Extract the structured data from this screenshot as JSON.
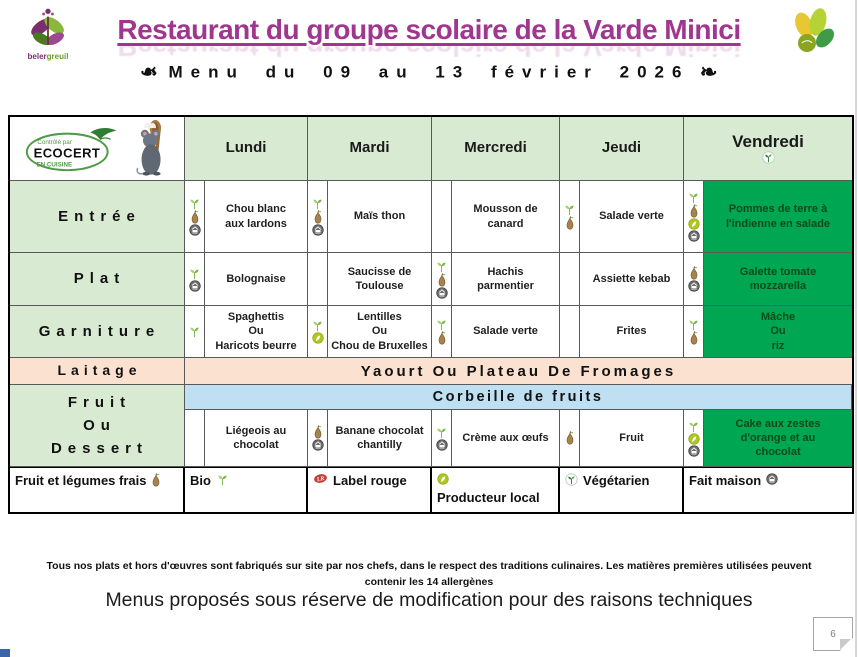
{
  "header": {
    "brand_part1": "beler",
    "brand_part2": "greuil",
    "title": "Restaurant du groupe scolaire de la Varde Minici",
    "subtitle": "Menu du 09 au 13 février 2026",
    "ornament": "❧"
  },
  "ecocert_logo": {
    "top": "Contrôlé par",
    "name": "ECOCERT",
    "bottom": "EN CUISINE"
  },
  "colors": {
    "title_purple": "#A0368F",
    "header_green": "#D9EAD3",
    "highlight_green": "#00A651",
    "laitage_peach": "#FBE2D0",
    "fruit_blue": "#BFE0F2"
  },
  "table": {
    "days": [
      {
        "label": "Lundi"
      },
      {
        "label": "Mardi"
      },
      {
        "label": "Mercredi"
      },
      {
        "label": "Jeudi"
      },
      {
        "label": "Vendredi",
        "icon": "vegetarian"
      }
    ],
    "rows": [
      {
        "label": "Entrée",
        "type": "dishes",
        "cells": [
          {
            "icons": [
              "bio",
              "fresh-produce",
              "homemade"
            ],
            "text": "Chou blanc\naux lardons"
          },
          {
            "icons": [
              "bio",
              "fresh-produce",
              "homemade"
            ],
            "text": "Maïs thon"
          },
          {
            "icons": [],
            "text": "Mousson de\ncanard"
          },
          {
            "icons": [
              "bio",
              "fresh-produce"
            ],
            "text": "Salade verte"
          },
          {
            "icons": [
              "bio",
              "fresh-produce",
              "local-producer",
              "homemade"
            ],
            "text": "Pommes de terre à\nl'indienne en salade",
            "highlight": true
          }
        ]
      },
      {
        "label": "Plat",
        "type": "dishes",
        "cells": [
          {
            "icons": [
              "bio",
              "homemade"
            ],
            "text": "Bolognaise"
          },
          {
            "icons": [],
            "text": "Saucisse de\nToulouse"
          },
          {
            "icons": [
              "bio",
              "fresh-produce",
              "homemade"
            ],
            "text": "Hachis\nparmentier"
          },
          {
            "icons": [],
            "text": "Assiette kebab"
          },
          {
            "icons": [
              "fresh-produce",
              "homemade"
            ],
            "text": "Galette tomate\nmozzarella",
            "highlight": true
          }
        ]
      },
      {
        "label": "Garniture",
        "type": "dishes",
        "cells": [
          {
            "icons": [
              "bio"
            ],
            "text": "Spaghettis\nOu\nHaricots beurre"
          },
          {
            "icons": [
              "bio",
              "local-producer"
            ],
            "text": "Lentilles\nOu\nChou de Bruxelles"
          },
          {
            "icons": [
              "bio",
              "fresh-produce"
            ],
            "text": "Salade verte"
          },
          {
            "icons": [],
            "text": "Frites"
          },
          {
            "icons": [
              "bio",
              "fresh-produce"
            ],
            "text": "Mâche\nOu\nriz",
            "highlight": true
          }
        ]
      },
      {
        "label": "Laitage",
        "type": "span",
        "text": "Yaourt Ou Plateau De Fromages"
      },
      {
        "label": "Fruit\nOu\nDessert",
        "type": "combo",
        "span_text": "Corbeille de fruits",
        "cells": [
          {
            "icons": [],
            "text": "Liégeois au\nchocolat"
          },
          {
            "icons": [
              "fresh-produce",
              "homemade"
            ],
            "text": "Banane chocolat\nchantilly"
          },
          {
            "icons": [
              "bio",
              "homemade"
            ],
            "text": "Crème aux œufs"
          },
          {
            "icons": [
              "fresh-produce"
            ],
            "text": "Fruit"
          },
          {
            "icons": [
              "bio",
              "local-producer",
              "homemade"
            ],
            "text": "Cake aux zestes\nd'orange et au\nchocolat",
            "highlight": true
          }
        ]
      }
    ],
    "legend": [
      {
        "text": "Fruit et légumes frais",
        "icon": "fresh-produce",
        "icon_pos": "after"
      },
      {
        "text": "Bio",
        "icon": "bio",
        "icon_pos": "after"
      },
      {
        "text": "Label rouge",
        "icon": "label-rouge",
        "icon_pos": "before"
      },
      {
        "text": "Producteur local",
        "icon": "local-producer",
        "icon_pos": "before"
      },
      {
        "text": "Végétarien",
        "icon": "vegetarian",
        "icon_pos": "before"
      },
      {
        "text": "Fait maison",
        "icon": "homemade",
        "icon_pos": "after"
      }
    ]
  },
  "footer": {
    "note_line1": "Tous nos plats et hors d'œuvres sont fabriqués sur site par nos chefs, dans le respect des traditions culinaires. Les matières premières utilisées peuvent",
    "note_line2": "contenir les 14 allergènes",
    "disclaimer": "Menus proposés sous réserve de modification pour des raisons techniques",
    "page_number": "6"
  }
}
